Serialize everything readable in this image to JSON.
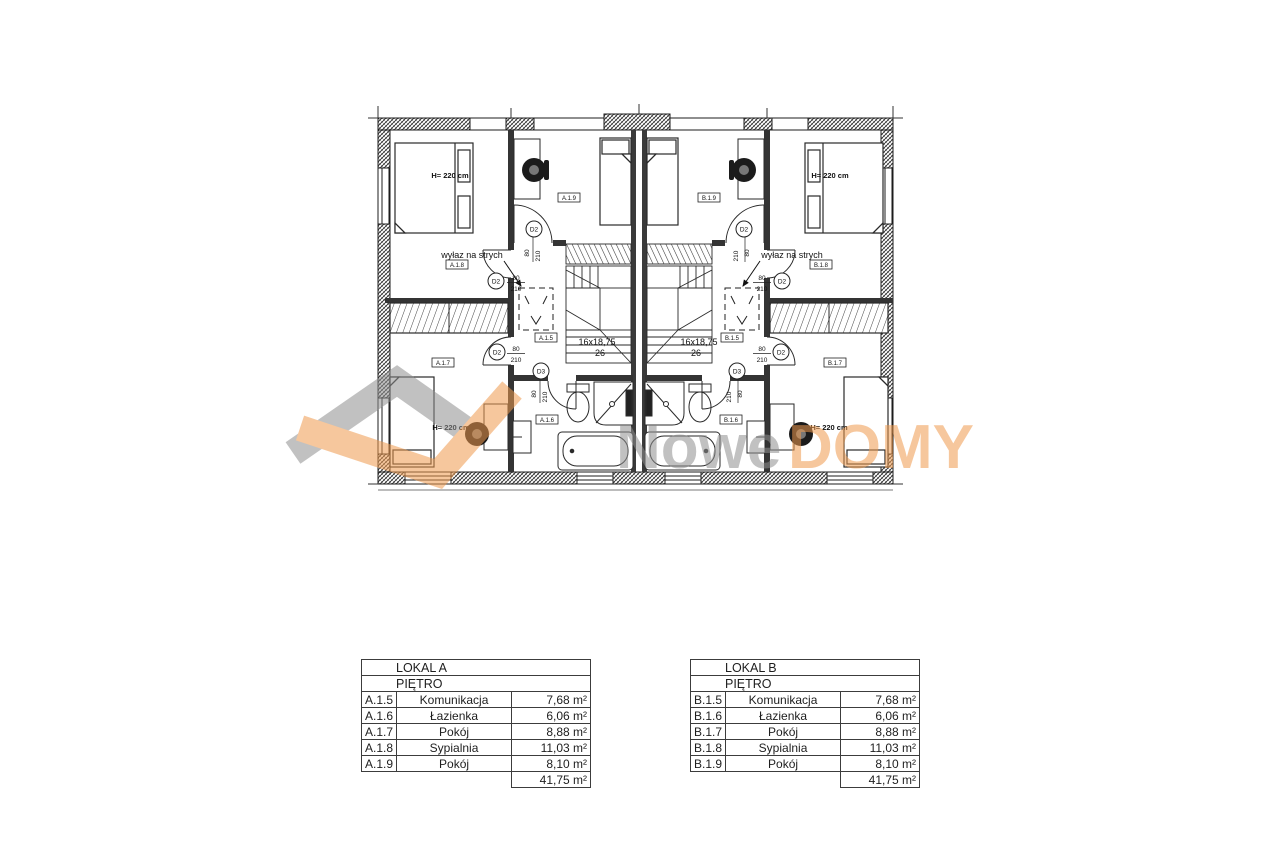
{
  "plan": {
    "attic_text": "wyłaz na strych",
    "bed_height_text": "H= 220 cm",
    "stairs_spec": "16x18,75",
    "stairs_width": "26",
    "door2": {
      "tag": "D2",
      "w": "80",
      "h": "210"
    },
    "door3": {
      "tag": "D3",
      "w": "80",
      "h": "210"
    },
    "room_tags": {
      "a15": "A.1.5",
      "a16": "A.1.6",
      "a17": "A.1.7",
      "a18": "A.1.8",
      "a19": "A.1.9",
      "b15": "B.1.5",
      "b16": "B.1.6",
      "b17": "B.1.7",
      "b18": "B.1.8",
      "b19": "B.1.9"
    }
  },
  "watermark": {
    "name_gray": "Nowe",
    "name_orange": "DOMY"
  },
  "colors": {
    "line": "#2a2a2a",
    "watermark_gray": "#8f8f8f",
    "watermark_orange": "#ef9a4e"
  },
  "tables": [
    {
      "title": "LOKAL A",
      "floor": "PIĘTRO",
      "rows": [
        {
          "code": "A.1.5",
          "name": "Komunikacja",
          "area": "7,68 m²"
        },
        {
          "code": "A.1.6",
          "name": "Łazienka",
          "area": "6,06 m²"
        },
        {
          "code": "A.1.7",
          "name": "Pokój",
          "area": "8,88 m²"
        },
        {
          "code": "A.1.8",
          "name": "Sypialnia",
          "area": "11,03 m²"
        },
        {
          "code": "A.1.9",
          "name": "Pokój",
          "area": "8,10 m²"
        }
      ],
      "total": "41,75 m²"
    },
    {
      "title": "LOKAL B",
      "floor": "PIĘTRO",
      "rows": [
        {
          "code": "B.1.5",
          "name": "Komunikacja",
          "area": "7,68 m²"
        },
        {
          "code": "B.1.6",
          "name": "Łazienka",
          "area": "6,06 m²"
        },
        {
          "code": "B.1.7",
          "name": "Pokój",
          "area": "8,88 m²"
        },
        {
          "code": "B.1.8",
          "name": "Sypialnia",
          "area": "11,03 m²"
        },
        {
          "code": "B.1.9",
          "name": "Pokój",
          "area": "8,10 m²"
        }
      ],
      "total": "41,75 m²"
    }
  ]
}
